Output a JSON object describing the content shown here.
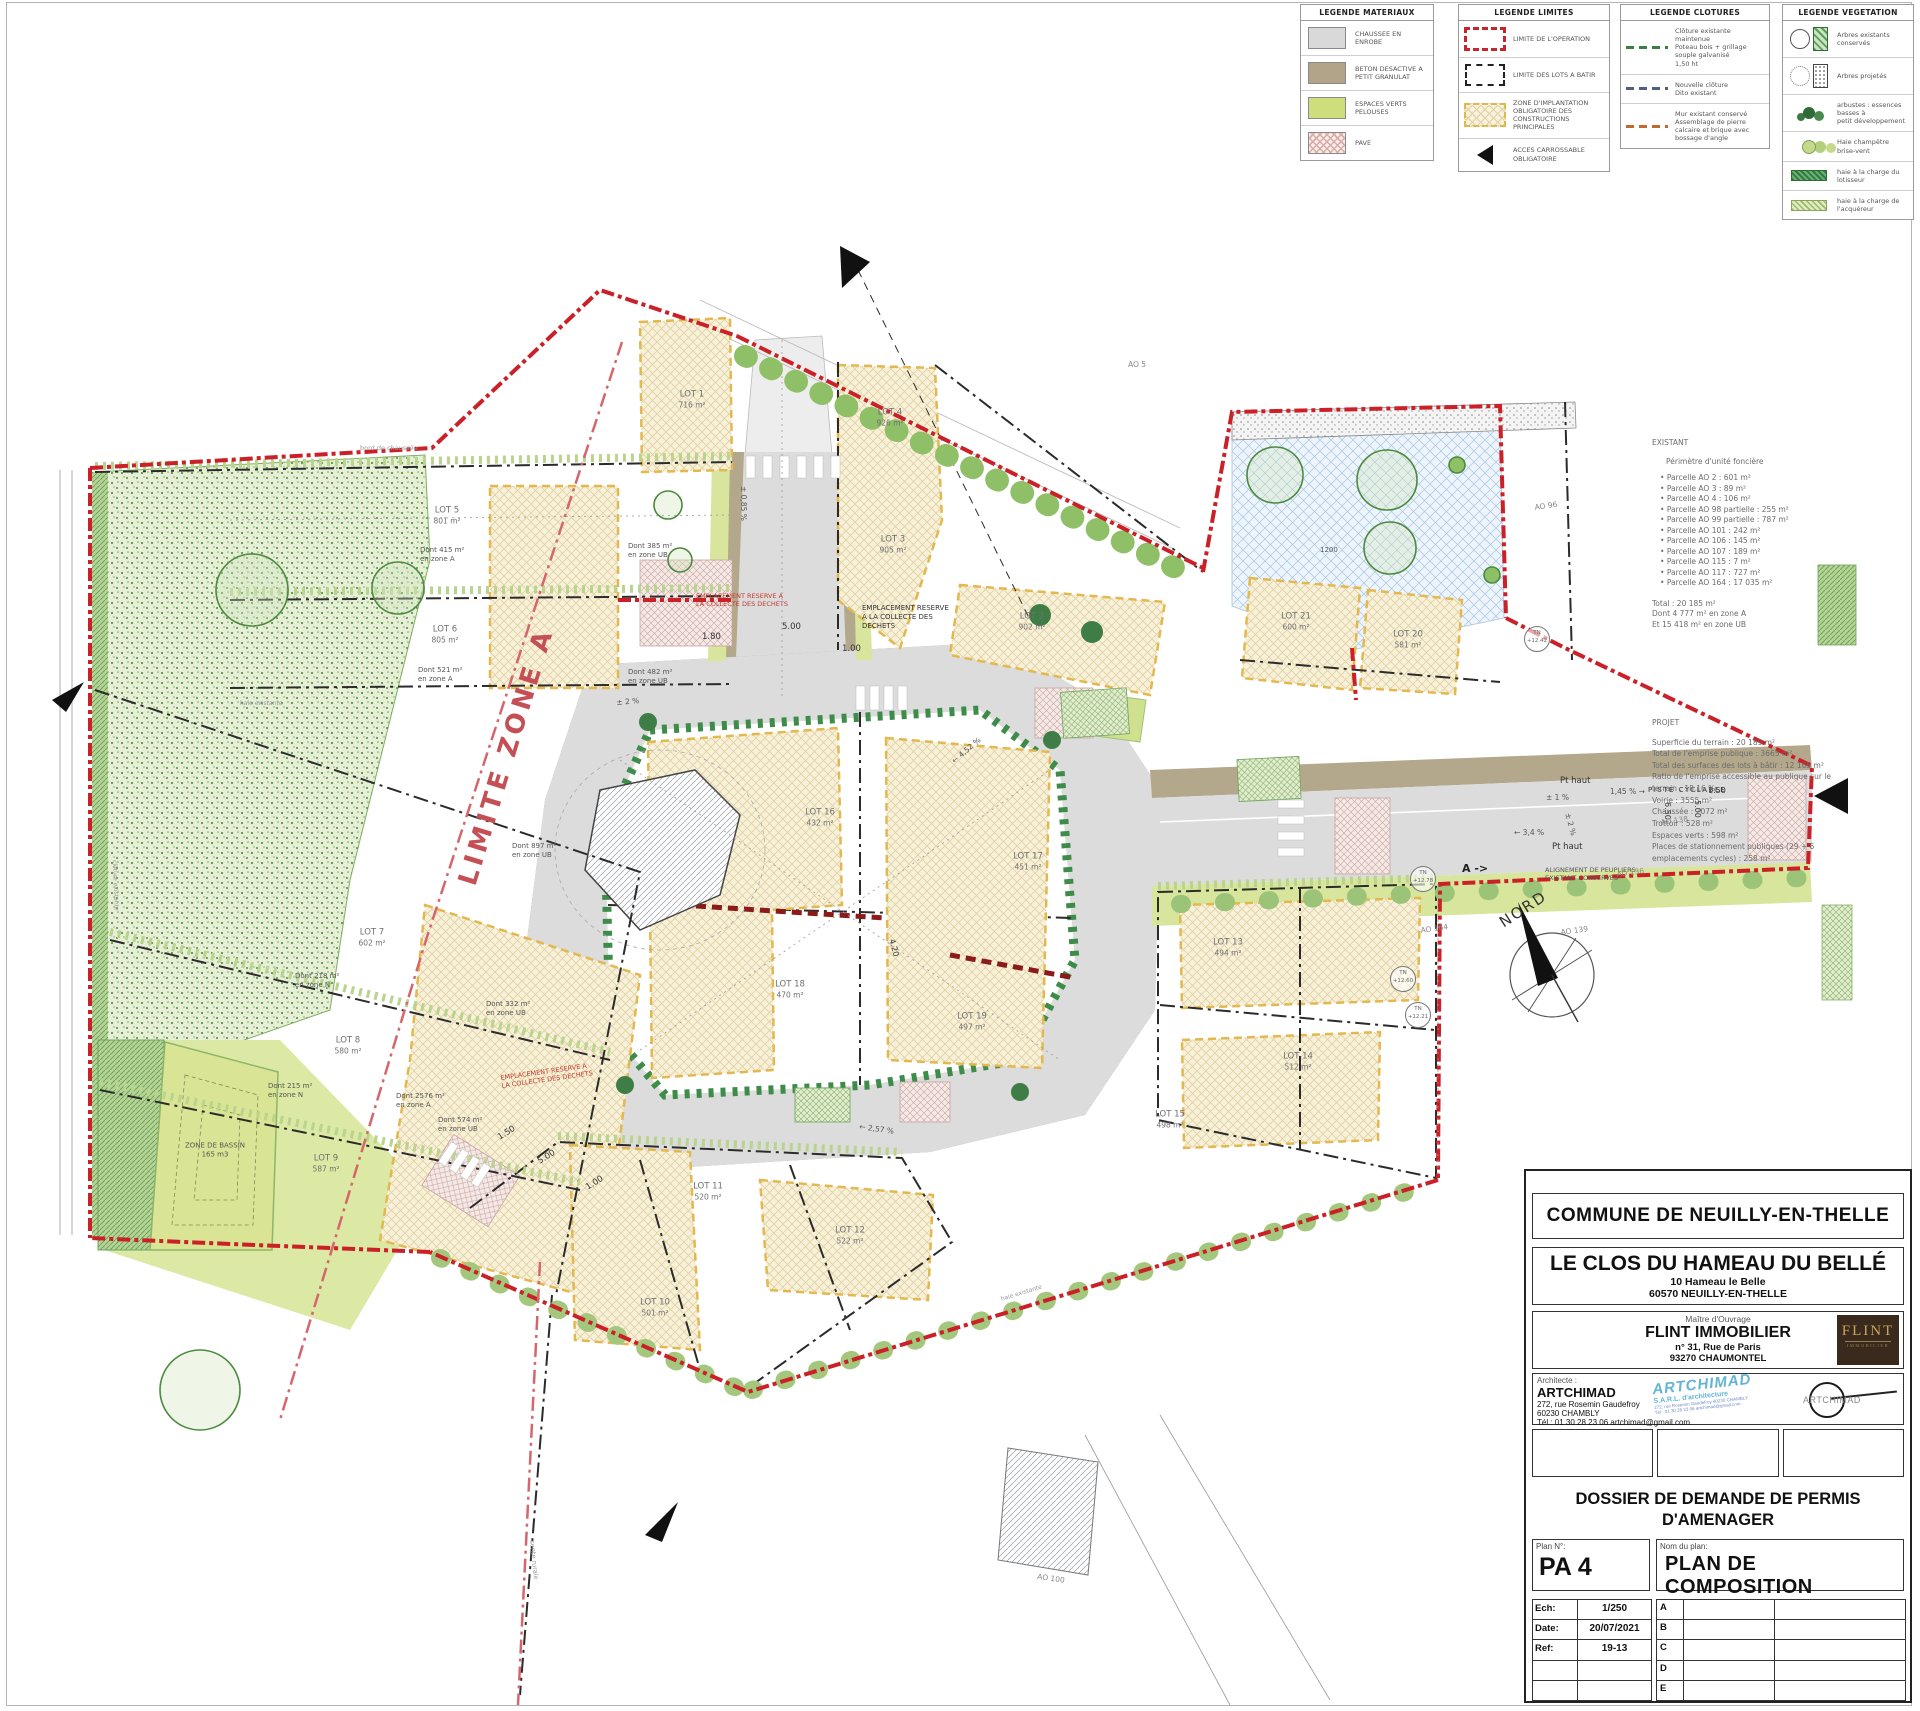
{
  "legends": {
    "materiaux": {
      "title": "LEGENDE MATERIAUX",
      "items": [
        {
          "label": "CHAUSSEE EN ENROBE"
        },
        {
          "label": "BETON DESACTIVE A\nPETIT GRANULAT"
        },
        {
          "label": "ESPACES VERTS\nPELOUSES"
        },
        {
          "label": "PAVE"
        }
      ]
    },
    "limites": {
      "title": "LEGENDE LIMITES",
      "items": [
        {
          "label": "LIMITE DE L'OPERATION"
        },
        {
          "label": "LIMITE DES LOTS A BATIR"
        },
        {
          "label": "ZONE D'IMPLANTATION\nOBLIGATOIRE DES\nCONSTRUCTIONS\nPRINCIPALES"
        },
        {
          "label": "ACCES CARROSSABLE\nOBLIGATOIRE"
        }
      ]
    },
    "clotures": {
      "title": "LEGENDE CLOTURES",
      "items": [
        {
          "label": "Clôture existante maintenue\nPoteau bois + grillage\nsouple galvanisé\n1,50 ht"
        },
        {
          "label": "Nouvelle clôture\nDito existant"
        },
        {
          "label": "Mur existant conservé\nAssemblage de pierre\ncalcaire et brique avec\nbossage d'angle"
        }
      ]
    },
    "vegetation": {
      "title": "LEGENDE VEGETATION",
      "items": [
        {
          "label": "Arbres existants conservés"
        },
        {
          "label": "Arbres projetés"
        },
        {
          "label": "arbustes : essences basses à\npetit développement"
        },
        {
          "label": "Haie champêtre brise-vent"
        },
        {
          "label": "haie à la charge du lotisseur"
        },
        {
          "label": "haie à la charge de l'acquéreur"
        }
      ]
    }
  },
  "notes": {
    "existant_title": "EXISTANT",
    "existant_subtitle": "Périmètre d'unité foncière",
    "parcelles": [
      "Parcelle AO 2 : 601 m²",
      "Parcelle AO 3 : 89 m²",
      "Parcelle AO 4 : 106 m²",
      "Parcelle AO 98 partielle : 255 m²",
      "Parcelle AO 99 partielle : 787 m²",
      "Parcelle AO 101 : 242 m²",
      "Parcelle AO 106 : 145 m²",
      "Parcelle AO 107 : 189 m²",
      "Parcelle AO 115 : 7 m²",
      "Parcelle AO 117 : 727 m²",
      "Parcelle AO 164 : 17 035 m²"
    ],
    "totaux": [
      "Total : 20 185 m²",
      "Dont 4 777 m² en zone A",
      "Et 15 418 m² en zone UB"
    ],
    "projet_title": "PROJET",
    "projet_lines": [
      "Superficie du terrain : 20 189 m²",
      "Total de l'emprise publique : 3665 m²",
      "Total des surfaces des lots à bâtir : 12 165 m²",
      "Ratio de l'emprise accessible au publique sur le terrain : 18,16 %",
      "Voirie : 3555 m²",
      "Chaussée : 2072 m²",
      "Trottoir : 528 m²",
      "Espaces verts : 598 m²",
      "Places de stationnement publiques (29 + 6 emplacements cycles) : 258 m²"
    ]
  },
  "map": {
    "labels": {
      "limite_zone_a": "LIMITE ZONE A",
      "nord": "NORD",
      "piste_cyclable": "PISTE CYCLABLE",
      "pt_haut": "Pt haut",
      "alignement": "ALIGNEMENT DE PEUPLIERS\nEXISTANT CONSERVES",
      "dechets_red": "EMPLACEMENT RESERVE A\nLA COLLECTE DES DECHETS",
      "dechets_black": "EMPLACEMENT RESERVE\nA LA COLLECTE DES\nDECHETS",
      "bassin": "ZONE DE BASSIN\n165 m3",
      "bord_chaussee": "bord de chaussée",
      "haie_existante": "haie existante",
      "cloture_existante": "clôture existante",
      "sente": "sente rurale",
      "section_a": "A ->"
    },
    "donts": [
      "Dont 2576 m²\nen zone A",
      "Dont 415 m²\nen zone A",
      "Dont 521 m²\nen zone A",
      "Dont 218 m²\nen zone N",
      "Dont 215 m²\nen zone N",
      "Dont 897 m²\nen zone UB",
      "Dont 385 m²\nen zone UB",
      "Dont 482 m²\nen zone UB",
      "Dont 332 m²\nen zone UB",
      "Dont 574 m²\nen zone UB"
    ],
    "lots": [
      {
        "name": "LOT 1",
        "area": "716 m²"
      },
      {
        "name": "LOT 2",
        "area": "902 m²"
      },
      {
        "name": "LOT 3",
        "area": "905 m²"
      },
      {
        "name": "LOT 4",
        "area": "926 m²"
      },
      {
        "name": "LOT 5",
        "area": "801 m²"
      },
      {
        "name": "LOT 6",
        "area": "805 m²"
      },
      {
        "name": "LOT 7",
        "area": "602 m²"
      },
      {
        "name": "LOT 8",
        "area": "580 m²"
      },
      {
        "name": "LOT 9",
        "area": "587 m²"
      },
      {
        "name": "LOT 10",
        "area": "501 m²"
      },
      {
        "name": "LOT 11",
        "area": "520 m²"
      },
      {
        "name": "LOT 12",
        "area": "522 m²"
      },
      {
        "name": "LOT 13",
        "area": "494 m²"
      },
      {
        "name": "LOT 14",
        "area": "512 m²"
      },
      {
        "name": "LOT 15",
        "area": "498 m²"
      },
      {
        "name": "LOT 16",
        "area": "432 m²"
      },
      {
        "name": "LOT 17",
        "area": "451 m²"
      },
      {
        "name": "LOT 18",
        "area": "470 m²"
      },
      {
        "name": "LOT 19",
        "area": "497 m²"
      },
      {
        "name": "LOT 20",
        "area": "581 m²"
      },
      {
        "name": "LOT 21",
        "area": "600 m²"
      }
    ],
    "dims": [
      "5.00",
      "1.00",
      "1.80",
      "1.50",
      "5.00",
      "1.00",
      "6.50",
      "5.00",
      "1.50",
      "4.20",
      "1200"
    ],
    "slopes": [
      "± 0,85 %",
      "± 2 %",
      "± 1 %",
      "± 2 %",
      "1,45 % →",
      "← 3,4 %",
      "← 2,57 %",
      "← 4,52 %"
    ],
    "refs": [
      "AO 5",
      "AO 96",
      "AO 136",
      "AO 138",
      "AO 139",
      "AO 164",
      "AO 100"
    ],
    "tn": [
      {
        "label": "TN",
        "value": "+12.78"
      },
      {
        "label": "TN",
        "value": "+12.60"
      },
      {
        "label": "TN",
        "value": "+12.21"
      },
      {
        "label": "TN",
        "value": "+12.42"
      }
    ]
  },
  "titleblock": {
    "commune": "COMMUNE DE NEUILLY-EN-THELLE",
    "project_title": "LE CLOS DU HAMEAU DU BELLÉ",
    "project_addr1": "10 Hameau le Belle",
    "project_addr2": "60570 NEUILLY-EN-THELLE",
    "mo_label": "Maître d'Ouvrage",
    "mo_name": "FLINT IMMOBILIER",
    "mo_addr1": "n° 31, Rue de Paris",
    "mo_addr2": "93270 CHAUMONTEL",
    "flint_logo_1": "FLINT",
    "flint_logo_2": "IMMOBILIER",
    "arch_label": "Architecte :",
    "arch_name": "ARTCHIMAD",
    "arch_addr1": "272, rue Rosemin Gaudefroy",
    "arch_addr2": "60230 CHAMBLY",
    "arch_tel": "Tél : 01 30 28 23 06  artchimad@gmail.com",
    "stamp_1": "ARTCHIMAD",
    "stamp_2": "S.A.R.L. d'architecture",
    "stamp_3": "272, rue Rosemin Gaudefroy 60230 CHAMBLY\nTél : 01 30 28 23 06  artchimad@gmail.com",
    "amark_name": "ARTCHI",
    "amark_suffix": "MAD",
    "dossier": "DOSSIER DE DEMANDE DE PERMIS\nD'AMENAGER",
    "plan_no_label": "Plan  N°:",
    "plan_no": "PA 4",
    "plan_name_label": "Nom du plan:",
    "plan_name": "PLAN DE COMPOSITION",
    "scale": [
      {
        "k": "Ech:",
        "v": "1/250"
      },
      {
        "k": "Date:",
        "v": "20/07/2021"
      },
      {
        "k": "Ref:",
        "v": "19-13"
      },
      {
        "k": "",
        "v": ""
      },
      {
        "k": "",
        "v": ""
      }
    ],
    "rev": [
      "A",
      "B",
      "C",
      "D",
      "E"
    ]
  }
}
